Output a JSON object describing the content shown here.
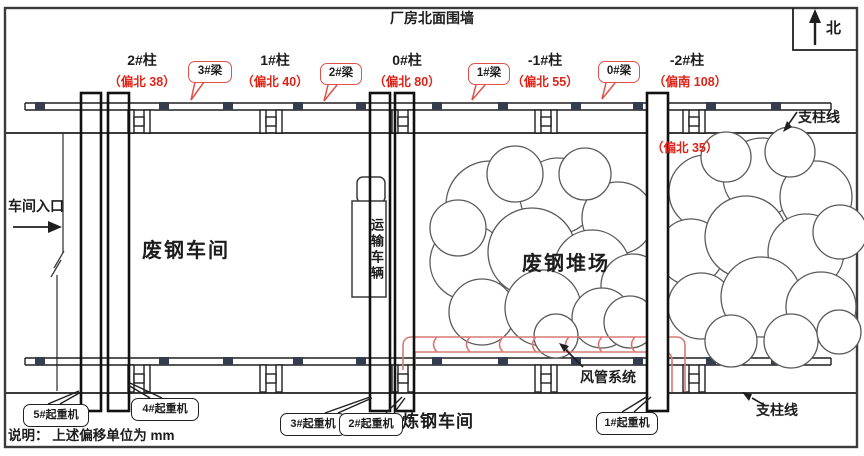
{
  "title": "厂房北面围墙",
  "compass": "北",
  "support_line": "支柱线",
  "entrance": "车间入口",
  "note": "说明： 上述偏移单位为 mm",
  "extra_offset": "（偏北 35）",
  "columns": [
    {
      "id": "2#柱",
      "offset": "（偏北 38）"
    },
    {
      "id": "1#柱",
      "offset": "（偏北 40）"
    },
    {
      "id": "0#柱",
      "offset": "（偏北 80）"
    },
    {
      "id": "-1#柱",
      "offset": "（偏北 55）"
    },
    {
      "id": "-2#柱",
      "offset": "（偏南 108）"
    }
  ],
  "beams": [
    "3#梁",
    "2#梁",
    "1#梁",
    "0#梁"
  ],
  "regions": {
    "scrap_workshop": "废钢车间",
    "transport_vehicle": "运输车辆",
    "scrap_yard": "废钢堆场",
    "steel_workshop": "炼钢车间",
    "duct_system": "风管系统"
  },
  "cranes": [
    "5#起重机",
    "4#起重机",
    "3#起重机",
    "2#起重机",
    "1#起重机"
  ],
  "colors": {
    "annotation_red": "#de2418",
    "bubble_red": "#e0514a",
    "duct_red": "#d87a74",
    "marker_dark": "#343c4e",
    "line_dark": "#1f1f1f",
    "frame_gray": "#3b3b3b"
  }
}
